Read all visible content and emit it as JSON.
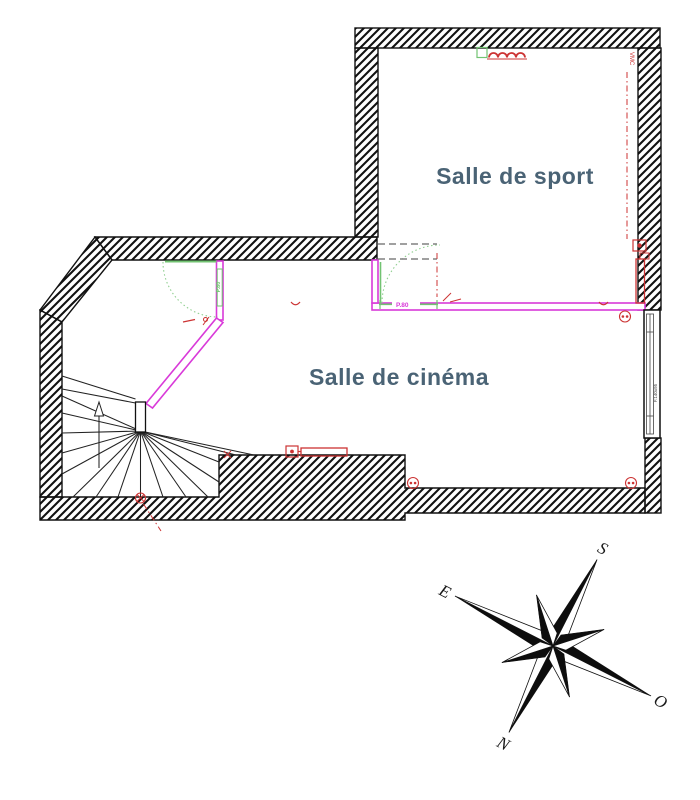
{
  "plan": {
    "rooms": [
      {
        "id": "sport",
        "label": "Salle de sport"
      },
      {
        "id": "cinema",
        "label": "Salle de cinéma"
      }
    ],
    "doors": [
      {
        "id": "door-hall",
        "label": "P.80"
      },
      {
        "id": "door-partition",
        "label": "P.80"
      }
    ],
    "window": {
      "label": "F.140x95"
    },
    "annotations": {
      "vent_label": "VMC"
    },
    "colors": {
      "wall": "#111111",
      "partition": "#d93ad9",
      "joinery_green": "#72c372",
      "services_red": "#cc3333",
      "room_label": "#4a6375"
    }
  },
  "compass": {
    "directions": [
      {
        "id": "south",
        "label": "S"
      },
      {
        "id": "east",
        "label": "E"
      },
      {
        "id": "west",
        "label": "O"
      },
      {
        "id": "north",
        "label": "N"
      }
    ]
  }
}
